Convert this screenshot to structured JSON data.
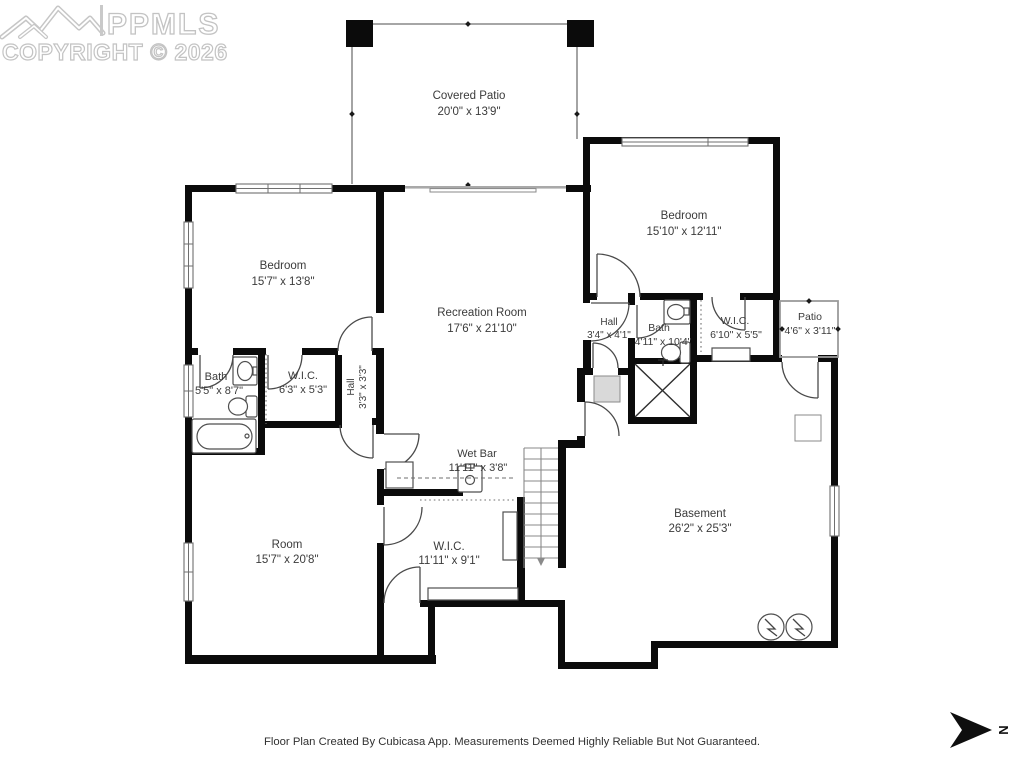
{
  "watermark": {
    "logo_text": "PPMLS",
    "copyright": "COPYRIGHT © 2026"
  },
  "rooms": [
    {
      "name": "Covered Patio",
      "dims": "20'0\" x 13'9\""
    },
    {
      "name": "Bedroom",
      "dims": "15'10\" x 12'11\""
    },
    {
      "name": "Bedroom",
      "dims": "15'7\" x 13'8\""
    },
    {
      "name": "Recreation Room",
      "dims": "17'6\" x 21'10\""
    },
    {
      "name": "Bath",
      "dims": "5'5\" x 8'7\""
    },
    {
      "name": "W.I.C.",
      "dims": "6'3\" x 5'3\""
    },
    {
      "name": "Hall",
      "dims": "3'3\" x 3'3\""
    },
    {
      "name": "Hall",
      "dims": "3'4\" x 4'1\""
    },
    {
      "name": "Bath",
      "dims": "4'11\" x 10'4\""
    },
    {
      "name": "W.I.C.",
      "dims": "6'10\" x 5'5\""
    },
    {
      "name": "Patio",
      "dims": "4'6\" x 3'11\""
    },
    {
      "name": "Wet Bar",
      "dims": "11'11\" x 3'8\""
    },
    {
      "name": "W.I.C.",
      "dims": "11'11\" x 9'1\""
    },
    {
      "name": "Room",
      "dims": "15'7\" x 20'8\""
    },
    {
      "name": "Basement",
      "dims": "26'2\" x 25'3\""
    }
  ],
  "footer": {
    "disclaimer": "Floor Plan Created By Cubicasa App. Measurements Deemed Highly Reliable But Not Guaranteed."
  },
  "compass": {
    "label": "N"
  },
  "colors": {
    "wall": "#0b0b0b",
    "label": "#3b3b3b",
    "watermark": "#c3c3c3",
    "thin_line": "#9a9a9a"
  }
}
